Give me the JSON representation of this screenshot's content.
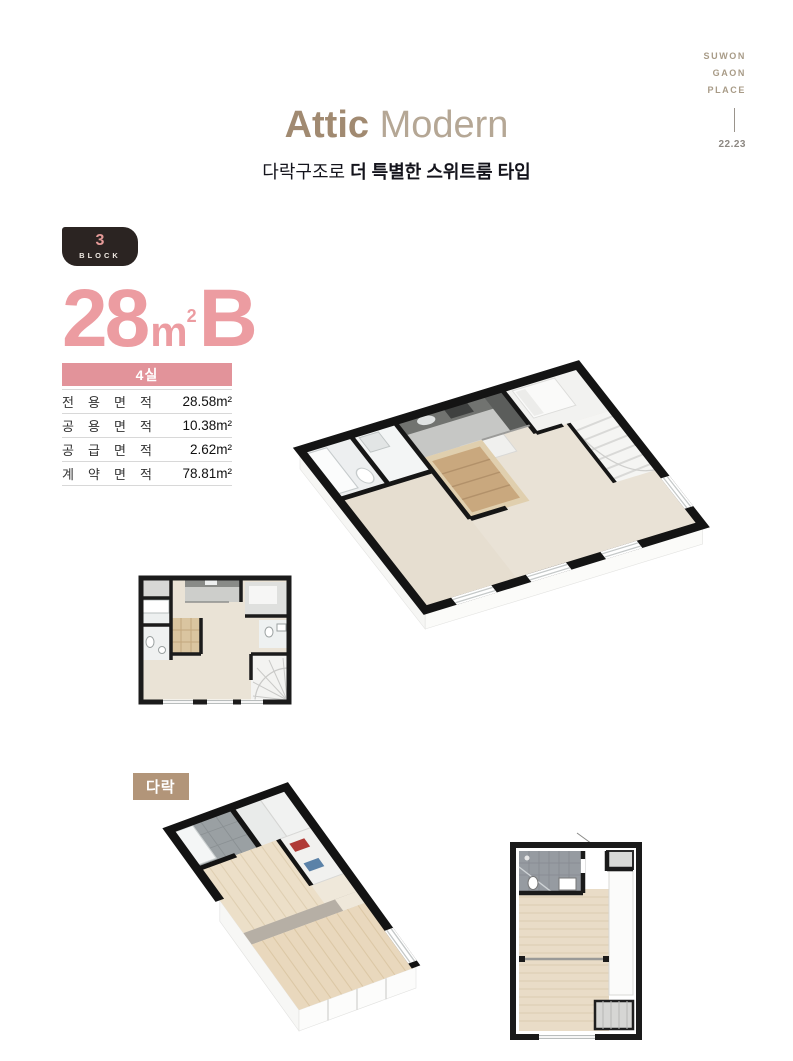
{
  "brand": {
    "lines": [
      "SUWON",
      "GAON",
      "PLACE"
    ],
    "page_number": "22.23"
  },
  "header": {
    "title_primary": "Attic",
    "title_secondary": "Modern",
    "subtitle_regular": "다락구조로 ",
    "subtitle_bold": "더 특별한 스위트룸 타입"
  },
  "unit": {
    "block": {
      "number": "3",
      "label": "BLOCK"
    },
    "name": {
      "number": "28",
      "unit_letter": "m",
      "unit_sup": "2",
      "type_letter": "B"
    },
    "rooms_badge": "4실"
  },
  "area_table": {
    "rows": [
      {
        "label": "전 용 면 적",
        "value": "28.58m²"
      },
      {
        "label": "공 용 면 적",
        "value": "10.38m²"
      },
      {
        "label": "공 급 면 적",
        "value": "2.62m²"
      },
      {
        "label": "계 약 면 적",
        "value": "78.81m²"
      }
    ]
  },
  "attic_section": {
    "label": "다락"
  },
  "colors": {
    "accent_pink": "#ec9ca1",
    "banner_pink": "#e2939a",
    "badge_bg": "#2b2422",
    "badge_number_pink": "#e59a98",
    "title_brown": "#a18a71",
    "title_light": "#b5a795",
    "subtitle_dark": "#14141c",
    "brand_tan": "#a89b87",
    "attic_label_tan": "#b29579",
    "floor_beige": "#e9e2d6",
    "wall_black": "#141414"
  }
}
